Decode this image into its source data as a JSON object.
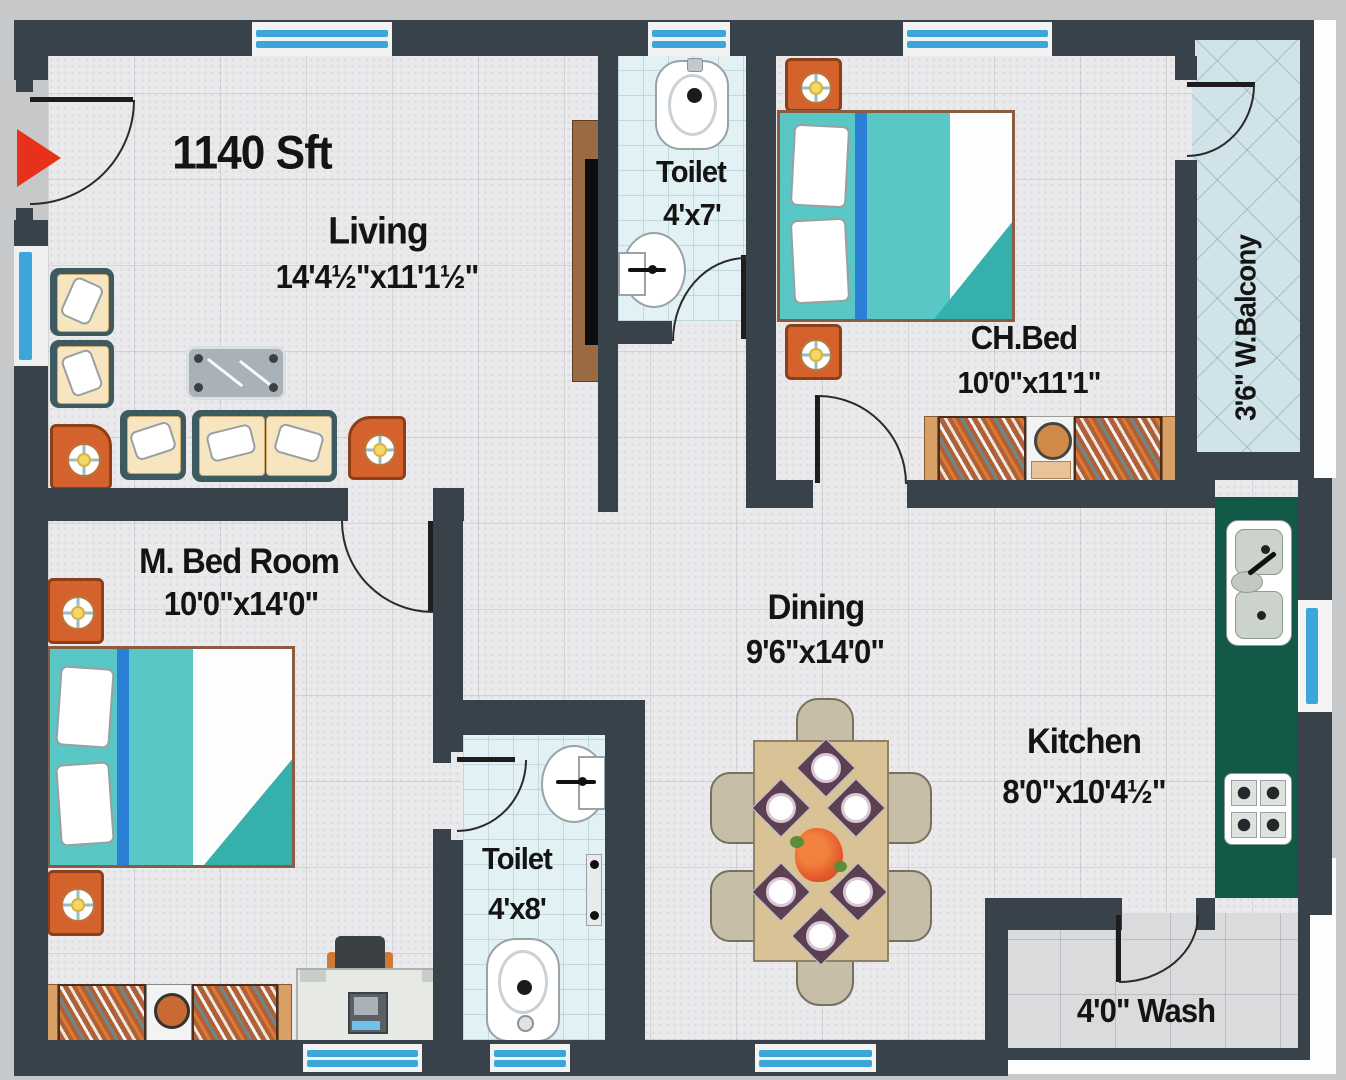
{
  "plan": {
    "area_label": "1140 Sft",
    "rooms": [
      {
        "id": "living",
        "name": "Living",
        "dims": "14'4½\"x11'1½\""
      },
      {
        "id": "toilet_top",
        "name": "Toilet",
        "dims": "4'x7'"
      },
      {
        "id": "ch_bed",
        "name": "CH.Bed",
        "dims": "10'0\"x11'1\""
      },
      {
        "id": "balcony",
        "name": "3'6\" W.Balcony"
      },
      {
        "id": "m_bed",
        "name": "M. Bed Room",
        "dims": "10'0\"x14'0\""
      },
      {
        "id": "dining",
        "name": "Dining",
        "dims": "9'6\"x14'0\""
      },
      {
        "id": "kitchen",
        "name": "Kitchen",
        "dims": "8'0\"x10'4½\""
      },
      {
        "id": "toilet_bottom",
        "name": "Toilet",
        "dims": "4'x8'"
      },
      {
        "id": "wash",
        "name": "4'0\" Wash"
      }
    ],
    "icons": {
      "entrance_arrow": "red-right-triangle",
      "furniture": [
        "sofa",
        "armchair",
        "coffee-table",
        "tv-unit",
        "double-bed",
        "nightstand-lamp",
        "wardrobe-with-mirror",
        "dressing-desk-chair",
        "dining-table-6-chairs",
        "kitchen-sink",
        "stove-4-burner",
        "toilet-wc",
        "wash-basin"
      ]
    },
    "colors": {
      "wall": "#37424b",
      "window_blue": "#3ba6da",
      "kitchen_counter_green": "#135947",
      "bed_teal": "#59c7c5",
      "bed_stripe_blue": "#2b7fd4",
      "furniture_orange": "#cf5f2c",
      "entrance_arrow_red": "#e8311a",
      "balcony_floor": "#cfe3e9",
      "toilet_floor": "#e2f1f3",
      "main_floor": "#eaeaec",
      "dining_table_tan": "#d9c296"
    }
  }
}
